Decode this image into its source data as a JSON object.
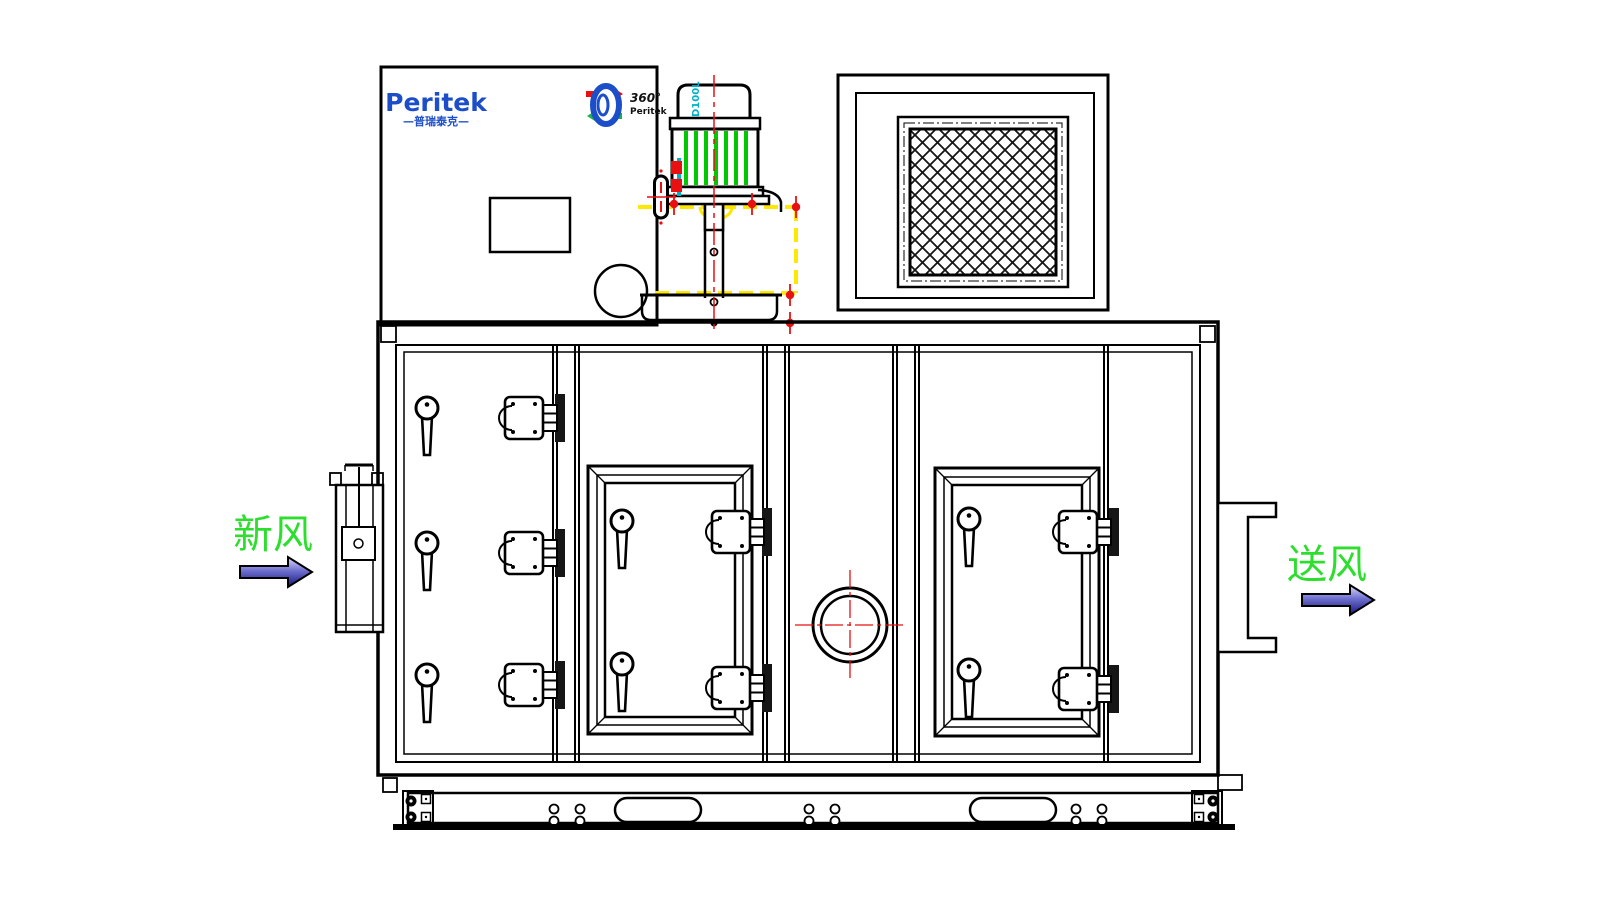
{
  "brand_panel": {
    "wordmark": "Peritek",
    "wordmark_cn": "—普瑞泰克—"
  },
  "rotor_logo": {
    "degree": "360°",
    "brand": "Peritek"
  },
  "motor": {
    "model": "D100L"
  },
  "airflow_labels": {
    "inlet": "新风",
    "outlet": "送风"
  },
  "colors": {
    "line": "#000000",
    "brand_blue": "#1d4ec9",
    "label_green": "#2ede2e",
    "fin_green": "#00c800",
    "accent_red": "#e81010",
    "accent_yellow": "#ffe800",
    "accent_cyan": "#00b0c8",
    "arrow_dark": "#15157e",
    "arrow_light": "#dcdcff"
  }
}
